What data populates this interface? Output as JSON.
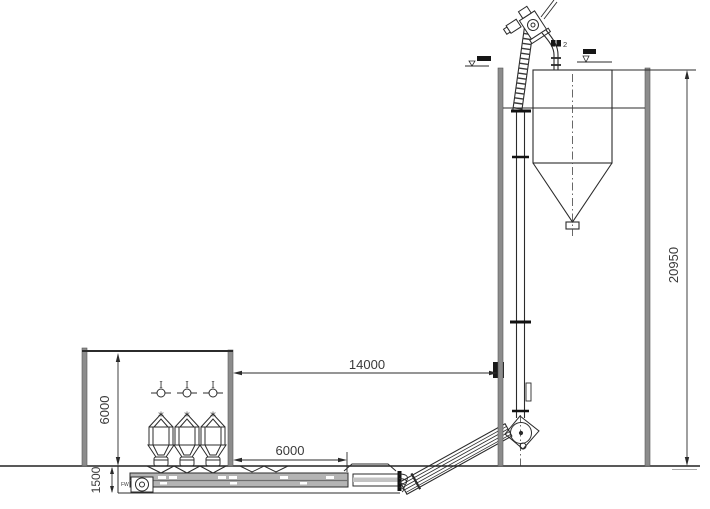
{
  "drawing": {
    "dimensions": {
      "overall_height": "20950",
      "horizontal_span": "14000",
      "building_height": "6000",
      "conveyor_length": "6000",
      "pit_depth": "1500"
    },
    "labels": {
      "machine_number": "2",
      "drive_label": "FW",
      "indicator_symbol": "I",
      "vent_symbol": "*"
    },
    "colors": {
      "line": "#2b2b2b",
      "wall_gray": "#8c8c8c",
      "conveyor_fill": "#b4b4b4",
      "background": "#ffffff"
    }
  }
}
